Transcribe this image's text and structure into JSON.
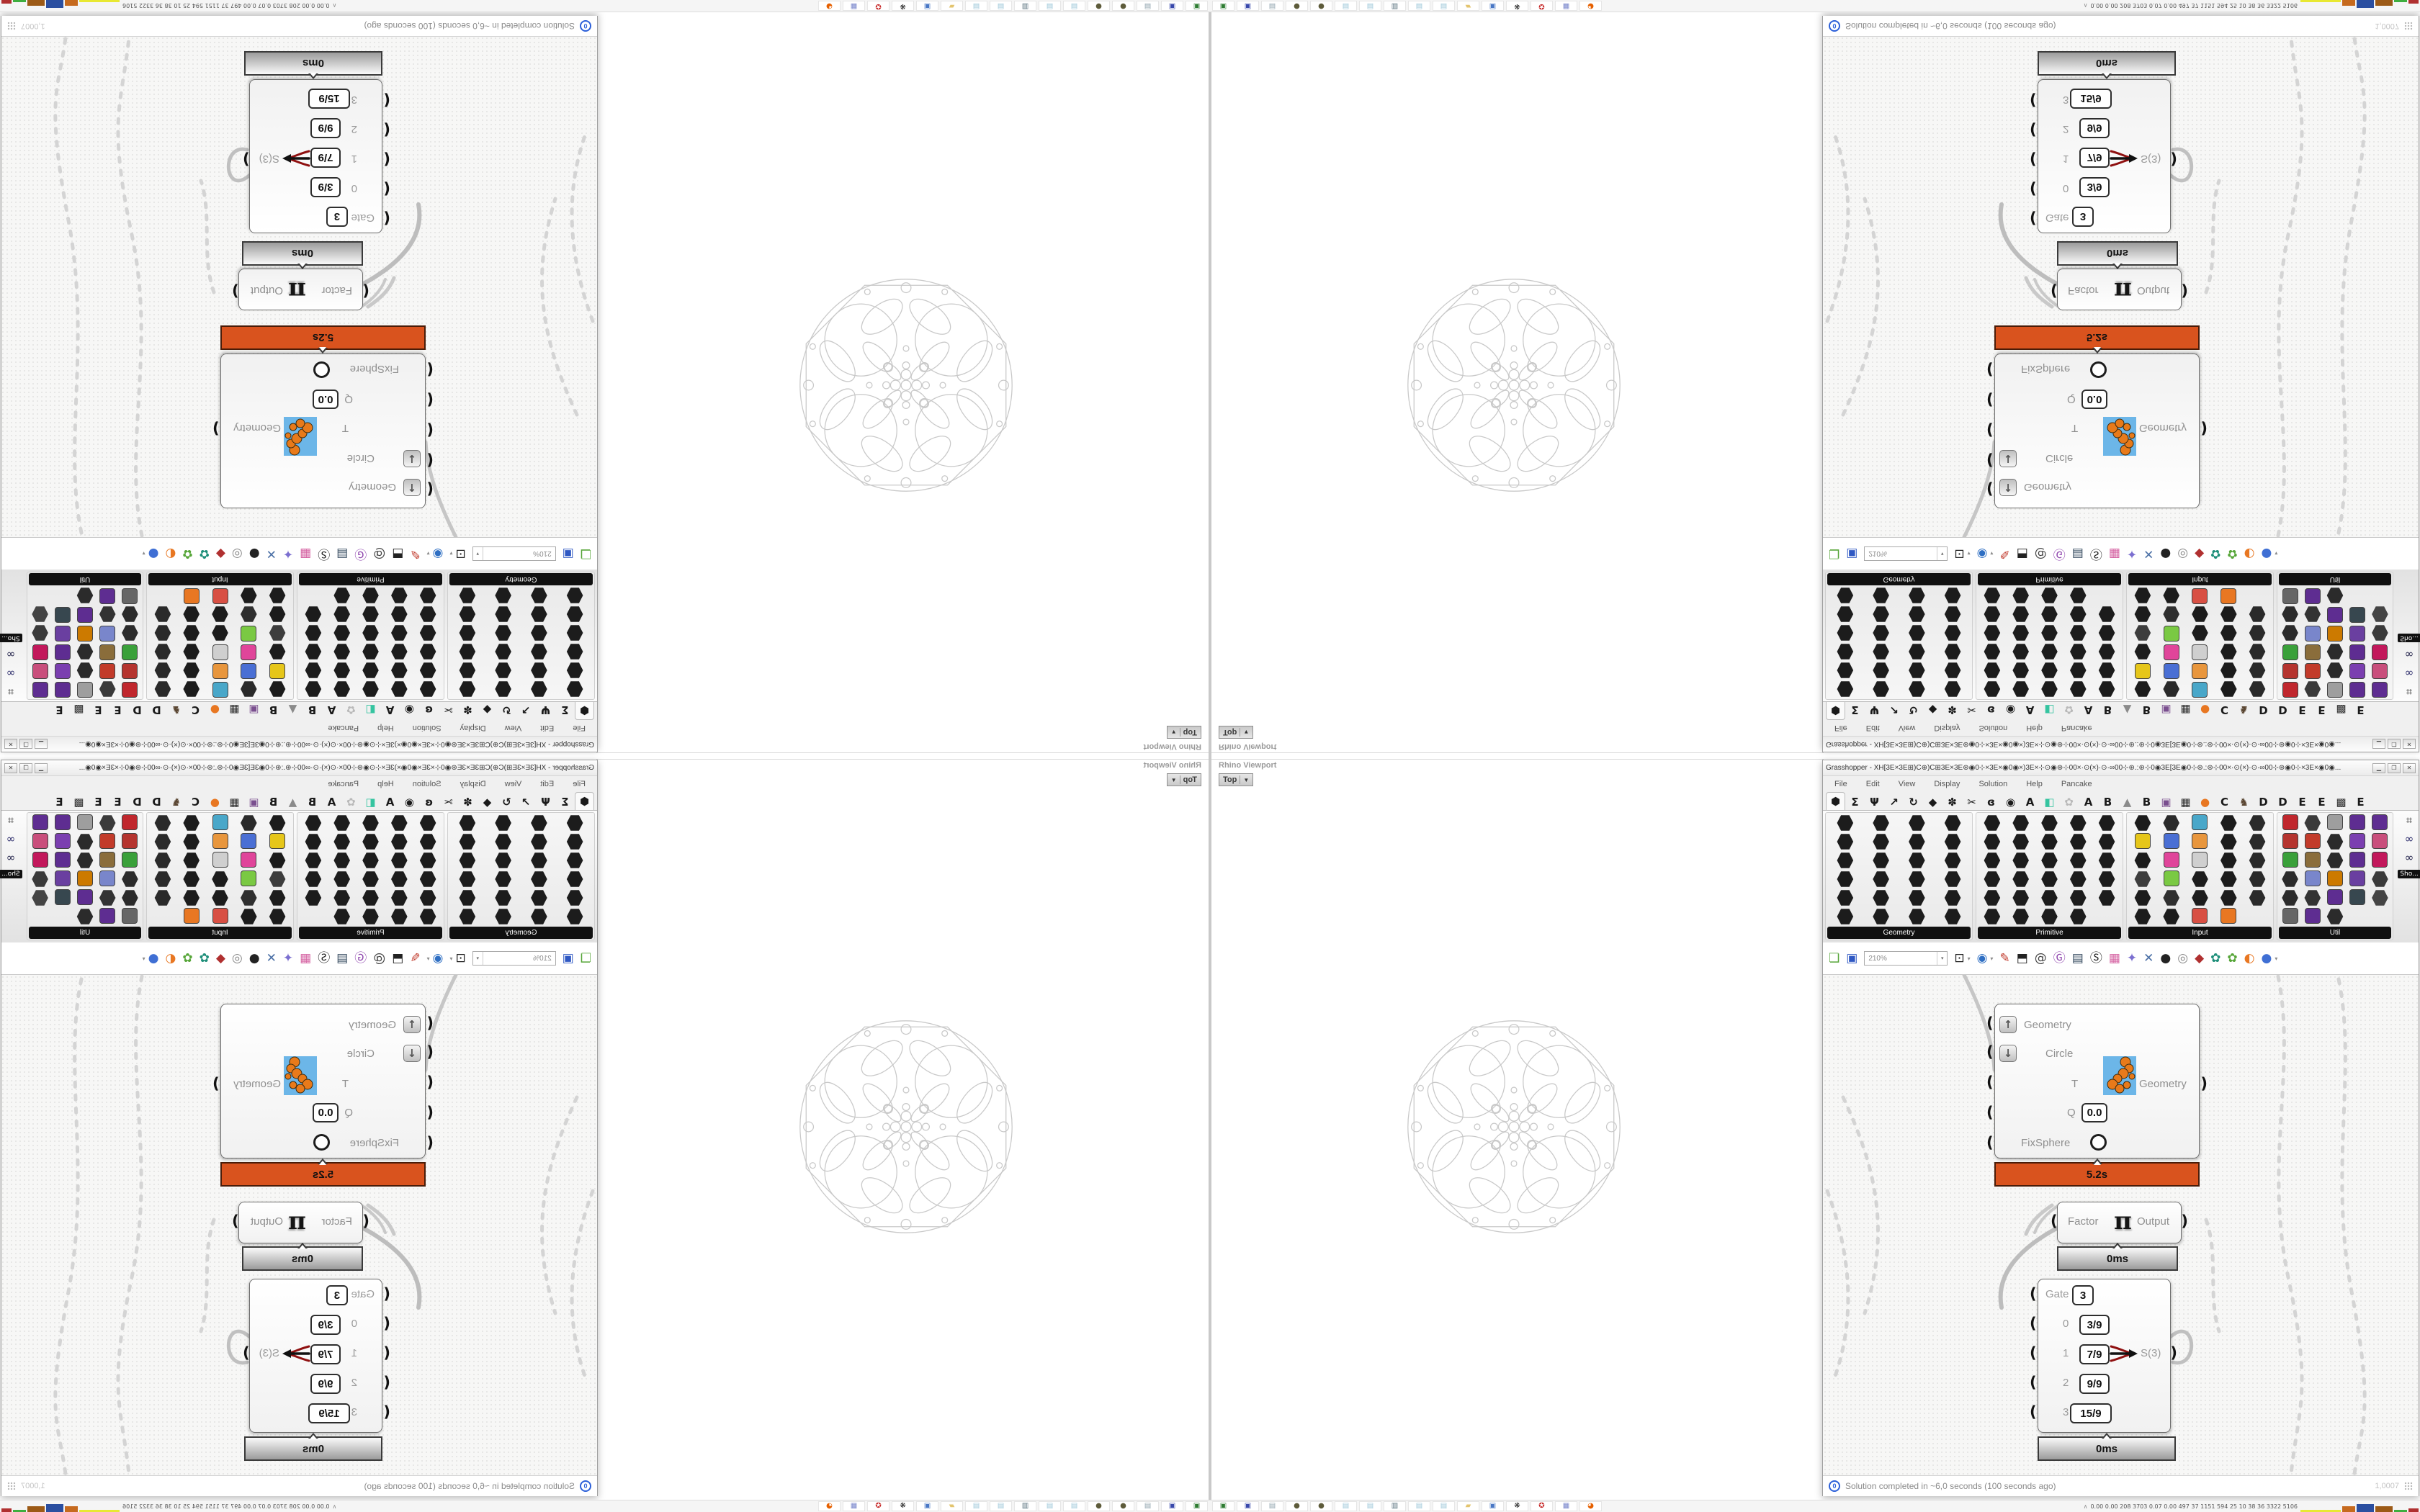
{
  "rhino": {
    "viewport_caption": "Rhino Viewport",
    "viewport_tab": "Top",
    "viewport_tab_caret": "▼"
  },
  "gh": {
    "title": "Grasshopper - XH[3E×3E⊞)C⊕)C⊞3E×3E⊛◉0⊹×3E×◉0◉×)3E×⊹⊙◉⊛⊹00×·⊙(×)·⊙·∞00⊹⊛.:⊛⊹0◉3E[3E◉0⊹⊛.:⊛⊹00×·⊙(×)·⊙·∞00⊹⊛◉0⊹×3E×◉0◉...",
    "window_buttons": {
      "minimize": "▁",
      "maximize": "❐",
      "close": "✕"
    },
    "menu": [
      "File",
      "Edit",
      "View",
      "Display",
      "Solution",
      "Help",
      "Pancake"
    ],
    "tab_icons": [
      {
        "g": "⬢",
        "c": "#1a1a1a",
        "first": true
      },
      {
        "g": "Σ",
        "c": "#1a1a1a"
      },
      {
        "g": "Ψ",
        "c": "#1a1a1a"
      },
      {
        "g": "↗",
        "c": "#1a1a1a"
      },
      {
        "g": "↻",
        "c": "#1a1a1a"
      },
      {
        "g": "◆",
        "c": "#1a1a1a"
      },
      {
        "g": "✽",
        "c": "#1a1a1a"
      },
      {
        "g": "✂",
        "c": "#1a1a1a"
      },
      {
        "g": "ɞ",
        "c": "#1a1a1a"
      },
      {
        "g": "◉",
        "c": "#1a1a1a"
      },
      {
        "g": "A",
        "c": "#1a1a1a"
      },
      {
        "g": "◧",
        "c": "#35c4a0"
      },
      {
        "g": "✿",
        "c": "#b9b9b9"
      },
      {
        "g": "A",
        "c": "#1a1a1a"
      },
      {
        "g": "B",
        "c": "#1a1a1a"
      },
      {
        "g": "▲",
        "c": "#8a8a8a"
      },
      {
        "g": "B",
        "c": "#1a1a1a"
      },
      {
        "g": "▣",
        "c": "#7a4f8f"
      },
      {
        "g": "▦",
        "c": "#2b2b2b"
      },
      {
        "g": "●",
        "c": "#e87722"
      },
      {
        "g": "C",
        "c": "#1a1a1a"
      },
      {
        "g": "♞",
        "c": "#5a4632"
      },
      {
        "g": "D",
        "c": "#1a1a1a"
      },
      {
        "g": "D",
        "c": "#1a1a1a"
      },
      {
        "g": "E",
        "c": "#1a1a1a"
      },
      {
        "g": "E",
        "c": "#1a1a1a"
      },
      {
        "g": "▩",
        "c": "#2b2b2b"
      },
      {
        "g": "E",
        "c": "#1a1a1a"
      }
    ],
    "palette": {
      "panels": [
        {
          "name": "Geometry",
          "cols": 4,
          "cells": [
            "#1c1c1c",
            "#1c1c1c",
            "#1c1c1c",
            "#1c1c1c",
            "#1c1c1c",
            "#1c1c1c",
            "#1c1c1c",
            "#1c1c1c",
            "#1c1c1c",
            "#1c1c1c",
            "#1c1c1c",
            "#1c1c1c",
            "#1c1c1c",
            "#1c1c1c",
            "#1c1c1c",
            "#1c1c1c",
            "#1c1c1c",
            "#1c1c1c",
            "#1c1c1c",
            "#1c1c1c",
            "#1c1c1c",
            "#1c1c1c",
            "#1c1c1c",
            "#1c1c1c"
          ]
        },
        {
          "name": "Primitive",
          "cols": 5,
          "cells": [
            "#1c1c1c",
            "#1c1c1c",
            "#1c1c1c",
            "#1c1c1c",
            "#1c1c1c",
            "#1c1c1c",
            "#1c1c1c",
            "#1c1c1c",
            "#1c1c1c",
            "#1c1c1c",
            "#1c1c1c",
            "#1c1c1c",
            "#1c1c1c",
            "#1c1c1c",
            "#1c1c1c",
            "#1c1c1c",
            "#1c1c1c",
            "#1c1c1c",
            "#1c1c1c",
            "#1c1c1c",
            "#1c1c1c",
            "#1c1c1c",
            "#1c1c1c",
            "#1c1c1c",
            "#1c1c1c",
            "#1c1c1c",
            "#1c1c1c",
            "#1c1c1c",
            "#1c1c1c"
          ]
        },
        {
          "name": "Input",
          "cols": 5,
          "cells": [
            "#1c1c1c",
            "#2a2a2a",
            "#49a7c9",
            "#1c1c1c",
            "#2a2a2a",
            "#e6c619",
            "#4a6fd4",
            "#e8963d",
            "#1c1c1c",
            "#2a2a2a",
            "#1c1c1c",
            "#e0459a",
            "#cfcfcf",
            "#1c1c1c",
            "#2a2a2a",
            "#3d3d3d",
            "#7ac943",
            "#1c1c1c",
            "#1c1c1c",
            "#2a2a2a",
            "#1c1c1c",
            "#2f2f2f",
            "#1c1c1c",
            "#1c1c1c",
            "#2a2a2a",
            "#1c1c1c",
            "#1c1c1c",
            "#d84f43",
            "#e87722"
          ]
        },
        {
          "name": "Util",
          "cols": 5,
          "cells": [
            "#c0272d",
            "#3a3a3a",
            "#9e9e9e",
            "#5e2d91",
            "#5e2d91",
            "#b5342f",
            "#c23b2a",
            "#2b2b2b",
            "#7b3fb0",
            "#c94f7c",
            "#3aa03a",
            "#8a6d3b",
            "#2b2b2b",
            "#5e2d91",
            "#c2185b",
            "#2b2b2b",
            "#7986cb",
            "#cc7a00",
            "#6a3fa0",
            "#3a3a3a",
            "#2b2b2b",
            "#333333",
            "#5e2d91",
            "#37474f",
            "#444444",
            "#666666",
            "#5e2d91",
            "#2b2b2b"
          ]
        }
      ],
      "extra_icons": [
        {
          "g": "∞",
          "c": "#1d1d46"
        },
        {
          "g": "∞",
          "c": "#2a2a6a"
        },
        {
          "g": "⌗",
          "c": "#1d1d1d"
        }
      ],
      "sho_label": "Sho..."
    },
    "toolbar": {
      "zoom_value": "210%",
      "icons": [
        {
          "name": "open-file-icon",
          "g": "❏",
          "c": "#57a639"
        },
        {
          "name": "save-file-icon",
          "g": "▣",
          "c": "#2f58c3"
        },
        {
          "name": "zoom-extents-icon",
          "g": "⊡",
          "c": "#222222",
          "caret": true
        },
        {
          "name": "preview-eye-icon",
          "g": "◉",
          "c": "#2f6fc3",
          "caret": true
        },
        {
          "name": "sketch-pen-icon",
          "g": "✎",
          "c": "#c0392b"
        },
        {
          "name": "camera-icon",
          "g": "⬒",
          "c": "#222222"
        },
        {
          "name": "remote-control-icon",
          "g": "@",
          "c": "#444444"
        },
        {
          "name": "gha-assembly-icon",
          "g": "Ⓖ",
          "c": "#8e44ad"
        },
        {
          "name": "navigate-map-icon",
          "g": "▤",
          "c": "#34495e"
        },
        {
          "name": "finder-icon",
          "g": "Ⓢ",
          "c": "#222222"
        },
        {
          "name": "package-icon",
          "g": "▦",
          "c": "#d45fa0"
        },
        {
          "name": "hints-bulb-icon",
          "g": "✦",
          "c": "#7b6fd0"
        },
        {
          "name": "wire-display-icon",
          "g": "✕",
          "c": "#4a6fa5"
        },
        {
          "name": "preview-blob-icon",
          "g": "●",
          "c": "#222222"
        },
        {
          "name": "preview-wireframe-icon",
          "g": "◎",
          "c": "#888888"
        },
        {
          "name": "preview-shaded-icon",
          "g": "◆",
          "c": "#b03030"
        },
        {
          "name": "leaf-teal-icon",
          "g": "✿",
          "c": "#1f8f7a"
        },
        {
          "name": "leaf-green-icon",
          "g": "✿",
          "c": "#57a639"
        },
        {
          "name": "half-sphere-icon",
          "g": "◐",
          "c": "#e87722"
        },
        {
          "name": "sphere-blue-icon",
          "g": "●",
          "c": "#3f6fd4",
          "caret": true
        }
      ]
    },
    "components": {
      "fixsphere": {
        "inputs": [
          "Geometry",
          "Circle",
          "T",
          "Q",
          "FixSphere"
        ],
        "q_value": "0.0",
        "output": "Geometry",
        "runtime": "5.2s"
      },
      "multiply": {
        "input": "Factor",
        "symbol": "π",
        "output": "Output",
        "runtime": "0ms"
      },
      "gate": {
        "rows": [
          [
            "Gate",
            "3"
          ],
          [
            "0",
            "3/9"
          ],
          [
            "1",
            "7/9"
          ],
          [
            "2",
            "9/9"
          ],
          [
            "3",
            "15/9"
          ]
        ],
        "output": "S(3)",
        "runtime": "0ms"
      }
    },
    "status": {
      "text": "Solution completed in ~6,0 seconds (100 seconds ago)",
      "zoom_factor": "1,0007"
    }
  },
  "taskbar": {
    "apps": [
      {
        "name": "cartridge-green-icon",
        "g": "▣",
        "c": "#2e7d32"
      },
      {
        "name": "floppy-64-icon",
        "g": "▣",
        "c": "#3949ab"
      },
      {
        "name": "scroll-icon",
        "g": "▤",
        "c": "#90a4ae"
      },
      {
        "name": "orb-icon",
        "g": "●",
        "c": "#5d5b3a"
      },
      {
        "name": "orb-icon",
        "g": "●",
        "c": "#5d5b3a"
      },
      {
        "name": "notepad-icon",
        "g": "▤",
        "c": "#9cc7d8"
      },
      {
        "name": "notepad-icon",
        "g": "▤",
        "c": "#9cc7d8"
      },
      {
        "name": "retro-computer-icon",
        "g": "▥",
        "c": "#546e7a"
      },
      {
        "name": "notepad-icon",
        "g": "▤",
        "c": "#9cc7d8"
      },
      {
        "name": "notepad-icon",
        "g": "▤",
        "c": "#9cc7d8"
      },
      {
        "name": "folder-icon",
        "g": "▰",
        "c": "#e3c46e"
      },
      {
        "name": "computer-icon",
        "g": "▣",
        "c": "#4a78c5"
      },
      {
        "name": "flame-icon",
        "g": "❋",
        "c": "#222222"
      },
      {
        "name": "red-badge-icon",
        "g": "✪",
        "c": "#c62828"
      },
      {
        "name": "calculator-icon",
        "g": "▦",
        "c": "#7986cb"
      },
      {
        "name": "firefox-icon",
        "g": "◕",
        "c": "#e66000"
      }
    ],
    "monitor": {
      "chevron": "∧",
      "values": "0.00 0.00  208 3703 0.07 0.00  497   37   1151 594   25    10    38    36   3322 5106",
      "bars": [
        {
          "c": "#e8e832",
          "w": 56,
          "h": 3
        },
        {
          "c": "#c66a1e",
          "w": 18,
          "h": 8
        },
        {
          "c": "#2b4fa0",
          "w": 24,
          "h": 11
        },
        {
          "c": "#9c5a17",
          "w": 24,
          "h": 8
        },
        {
          "c": "#3fae3f",
          "w": 18,
          "h": 3
        },
        {
          "c": "#b03030",
          "w": 14,
          "h": 5
        }
      ]
    }
  }
}
